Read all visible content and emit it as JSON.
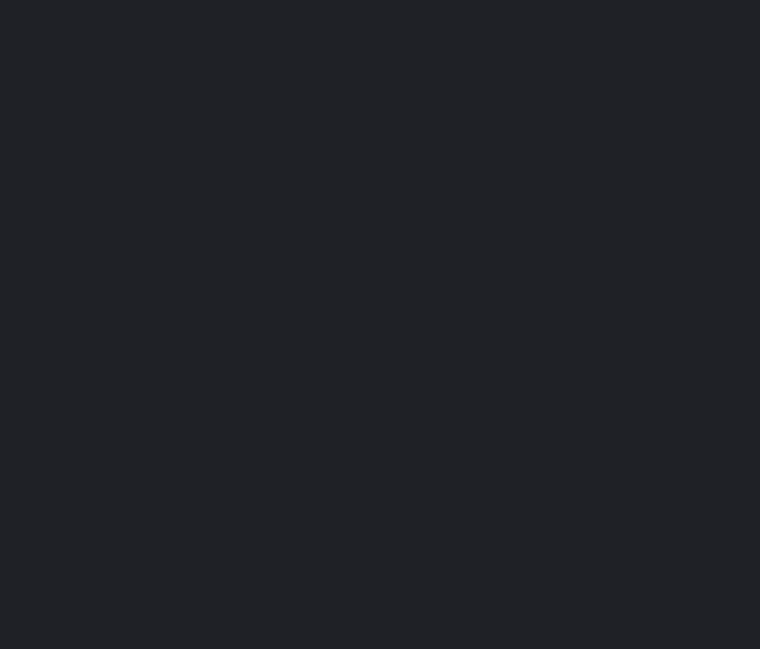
{
  "screen": {
    "background_color": "#1F2126"
  }
}
